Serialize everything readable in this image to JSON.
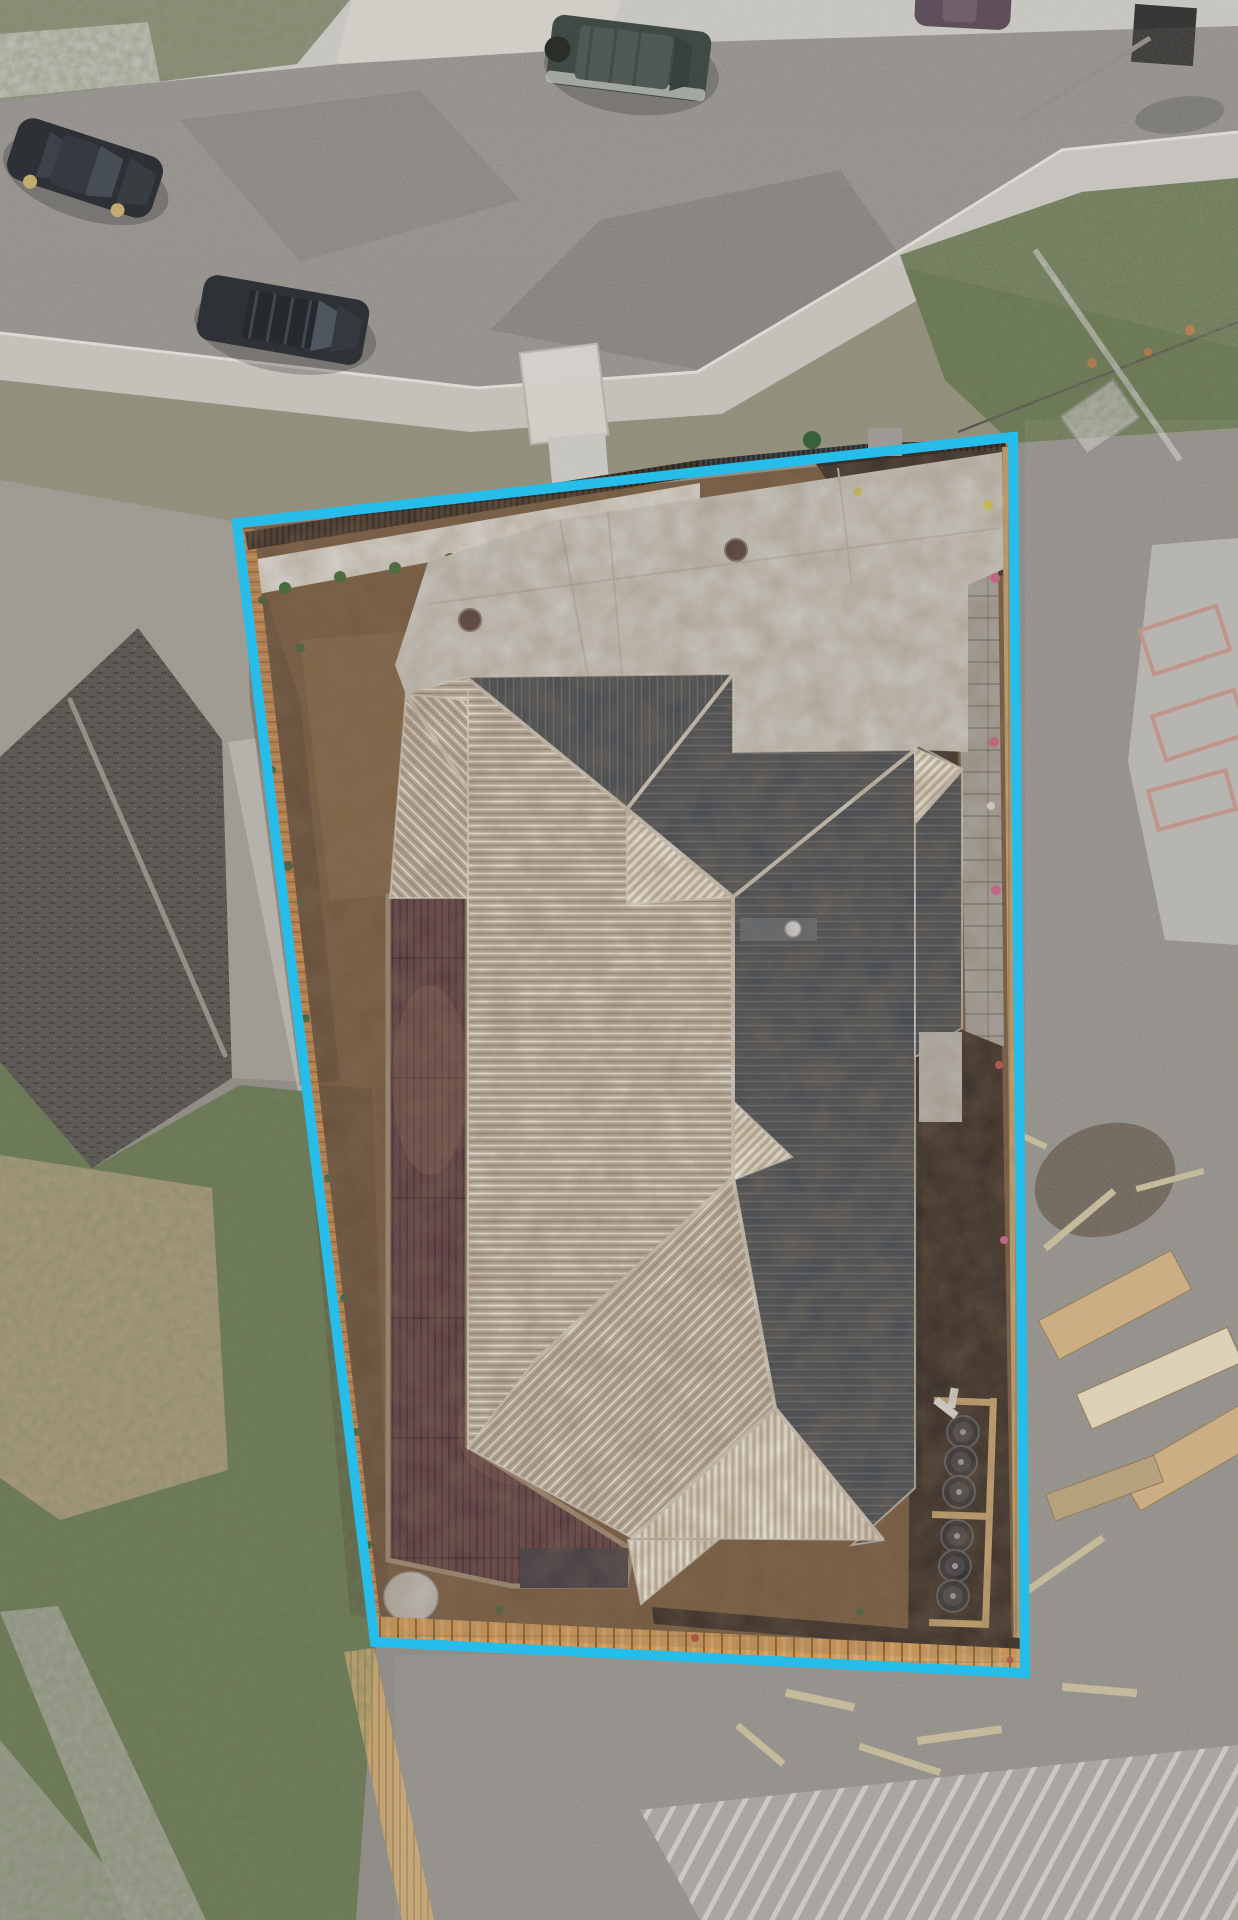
{
  "meta": {
    "type": "aerial-drone-photo",
    "subject": "residential lot with highlighted property boundary",
    "canvas": {
      "w": 1238,
      "h": 1920
    }
  },
  "colors": {
    "cyan": "#27bdea",
    "concrete": "#c8c6c0",
    "concrete_bright": "#d2cfc9",
    "path": "#c4c1bb",
    "kerb": "#dedbd5",
    "asphalt": "#8e8b86",
    "asphalt_arm": "#8a8781",
    "grass_verge": "#8f8d79",
    "grass_green": "#66724f",
    "grass_dark": "#3d5c35",
    "debris": "#98948b",
    "side_strip": "#b0ada6",
    "dirt": "#6f5339",
    "dirt_light": "#8a6a48",
    "soil_dark": "#4b3a2a",
    "pebble": "#d7d5cf",
    "fence_dark": "#33261d",
    "fence_orange": "#c28144",
    "gate_dark": "#23262a",
    "pillar": "#9b9893",
    "paling": "#c2a06b",
    "plank_orange": "#cd9550",
    "mulch": "#302620",
    "blockwall": "#a3a09a",
    "roof_dark": "#3e444b",
    "roof_dark_rib": "#59616b",
    "roof_light": "#b5aa9c",
    "roof_pale": "#d3cab7",
    "ridge": "#cdc7bc",
    "hatch_gray": "#5a6169",
    "deck": "#59383f",
    "deck_frame": "#97846f",
    "deck_patch": "#8a5f52",
    "steps_dark": "#3a343e",
    "porch": "#b5b3ae",
    "stone": "#b9b7b2",
    "shingle": "#56534d",
    "shingle_ridge": "#908d85",
    "slab": "#b2b0aa",
    "gravel": "#8d8a84",
    "tank": "#27272b",
    "tank_mid": "#3c3c42",
    "tank_dot": "#9a9aa0",
    "pipe_white": "#dcdcda",
    "car_hatch": "#23272c",
    "car_suv": "#24282e",
    "car_offroad": "#37423c",
    "car_sedan": "#584754",
    "wheel_gold": "#c2a96c",
    "glass": "#3f464e",
    "frame_pink": "#bd8b80",
    "lumber": "#c9a878",
    "lumber_light": "#ddd0b2",
    "stick": "#c2b694",
    "cone_orange": "#c96f3a",
    "plant_green": "#2f5a2f",
    "shrub_green": "#38642f",
    "flower_yellow": "#d9cf4a",
    "flower_pink": "#cf5f8a",
    "flower_white": "#ddd8d2",
    "flower_red": "#c04545",
    "red_bit": "#b5472f",
    "dark_object": "#2f2e2c"
  },
  "boundary": {
    "points": "237,523 1013,437 1025,1673 375,1642",
    "width": 10
  },
  "ground": {
    "top_concrete": "0,0 1238,0 1238,28 700,44 340,66 0,100",
    "grass_top_left": "0,0 350,0 297,64 0,102",
    "sidewalk_left": "0,34 148,22 162,92 0,108",
    "driveway_crossing": "352,0 622,0 588,92 424,98 336,62",
    "road": "0,98 340,64 700,42 1238,26 1238,132 1062,150 882,262 697,372 477,388 0,333",
    "road_arm": "882,262 1062,150 1238,132 1238,335 1085,348",
    "road_shadow1": "490,330 700,370 900,255 840,170 600,220",
    "road_shadow2": "180,120 420,90 520,200 300,262",
    "footpath": "0,333 477,388 697,372 882,262 1062,150 1238,132 1238,178 1082,192 918,300 722,414 470,432 0,380",
    "kerb_line": "0,333 477,388 697,372 882,262 1062,150 1238,132",
    "verge": "0,380 470,432 722,414 918,300 1082,192 1238,178 1238,430 1012,443 560,488 238,522 0,480",
    "verge_green": "900,255 1082,192 1238,178 1238,428 1012,443 945,380",
    "temp_fence": "958,432 1238,322",
    "debris_left": "0,480 238,522 310,1082 232,1078 222,740 138,628 0,757",
    "side_strip": "228,742 256,738 322,1086 298,1092",
    "grass_bl": "0,1062 92,1168 240,1085 312,1092 376,1640 356,1920 0,1920",
    "dirt_patch_bl": "0,1155 212,1188 228,1470 60,1520 0,1478",
    "pale_band_bl": "0,1612 58,1606 206,1920 126,1920",
    "pale_corner_bl": "0,1740 150,1920 0,1920",
    "slab_bottom": "398,1666 1030,1692 1238,1700 1238,1920 432,1920",
    "fence_bottom": "344,1652 374,1648 434,1920 402,1920",
    "frames_bottom": "640,1810 1238,1745 1238,1920 700,1920",
    "slab_right": "1128,762 1152,545 1238,538 1238,945 1165,940",
    "entry_steps": {
      "x": -39,
      "y": -46,
      "w": 78,
      "h": 92,
      "transform": "translate(564,394) rotate(-7)"
    },
    "entry_path": "548,438 605,432 612,520 556,528",
    "poles": [
      "1035,250 1180,460",
      "1018,122 1150,38"
    ],
    "dark_object": {
      "x": -31,
      "y": -29,
      "w": 62,
      "h": 58,
      "transform": "translate(1164,35) rotate(4)"
    },
    "pallet": {
      "x": -32,
      "y": -23,
      "w": 64,
      "h": 46,
      "transform": "translate(1100,417) rotate(-35)"
    },
    "mulch_heap": {
      "cx": 1105,
      "cy": 1180,
      "rx": 72,
      "ry": 55,
      "transform": "rotate(-20 1105 1180)"
    }
  },
  "lot": {
    "dirt": "243,528 1008,446 1020,1662 380,1634",
    "dirt_light_patch": "300,640 560,620 580,880 330,900",
    "dirt_dark_left": "245,532 300,700 340,1080 300,1085 250,700",
    "dirt_dark_bl": "305,1085 372,1088 390,1620 350,1615",
    "pebble_bed": "252,560 700,483 700,512 258,594",
    "fence_top": "245,532 700,460 700,476 248,550",
    "gate": "700,460 875,443 875,453 700,470",
    "fence_top_right": "875,443 1005,440 1005,452 875,452",
    "pillar": {
      "x": 868,
      "y": 428,
      "w": 34,
      "h": 28
    },
    "fence_left": "242,530 254,529 382,1633 369,1635",
    "mulch_top_right": "812,458 1006,444 1008,575 905,585 855,522",
    "blockwall": "957,560 998,553 1004,1046 966,1049",
    "blockwall_curve": "868,480 960,560 940,575 850,497",
    "mulch_right": "915,748 958,745 962,1030 1002,1046 1012,1655 908,1650",
    "paling_right": "1002,447 1016,446 1030,1662 1014,1660",
    "porch": {
      "x": 919,
      "y": 1032,
      "w": 43,
      "h": 90
    },
    "mulch_bottom": "652,1607 1020,1638 1022,1655 654,1624",
    "planks_bottom": "372,1616 1024,1649 1027,1677 376,1644",
    "stone": {
      "cx": 411,
      "cy": 1597,
      "rx": 27,
      "ry": 25
    },
    "plant": {
      "cx": 812,
      "cy": 440,
      "r": 9
    },
    "tank_frames": [
      {
        "x": -29,
        "y": -4,
        "w": 58,
        "h": 7,
        "transform": "translate(963,1402) rotate(2)"
      },
      {
        "x": -29,
        "y": -4,
        "w": 58,
        "h": 7,
        "transform": "translate(961,1516) rotate(2)"
      },
      {
        "x": -30,
        "y": -4,
        "w": 60,
        "h": 7,
        "transform": "translate(959,1624) rotate(2)"
      },
      {
        "x": -4,
        "y": -114,
        "w": 7,
        "h": 228,
        "transform": "translate(990,1512) rotate(2)"
      }
    ],
    "pipe1": {
      "x": -13,
      "y": -4,
      "w": 26,
      "h": 8,
      "transform": "translate(946,1408) rotate(38)"
    },
    "pipe2": {
      "x": -4,
      "y": -10,
      "w": 8,
      "h": 20,
      "transform": "translate(953,1398) rotate(10)"
    }
  },
  "driveway": {
    "slab": "395,665 428,562 556,520 1002,452 1006,568 968,585 968,752 919,750 733,752 733,674 466,677 406,695",
    "joints": [
      "560,520 588,676",
      "838,468 852,585",
      "428,604 1000,528",
      "608,512 622,674"
    ],
    "drains": [
      {
        "cx": 470,
        "cy": 620
      },
      {
        "cx": 736,
        "cy": 550
      }
    ],
    "eave_shadow_top": "406,698 733,680",
    "eave_shadow_right": "919,755 919,1488"
  },
  "deck": {
    "body": "388,896 468,894 468,1446 632,1550 626,1586 512,1586 388,1560",
    "steps": {
      "x": 520,
      "y": 1548,
      "w": 108,
      "h": 40
    },
    "patch1": {
      "cx": 430,
      "cy": 1080,
      "rx": 38,
      "ry": 95
    },
    "patch2": {
      "cx": 520,
      "cy": 1430,
      "rx": 62,
      "ry": 55
    }
  },
  "roof": {
    "garage": "406,694 468,700 468,898 390,898",
    "light_main": "466,677 627,809 733,897 733,1178 534,1362 468,1448 468,700 406,694",
    "dark_front": "466,677 733,674 627,809",
    "dark_main": "733,674 733,752 915,750 915,1488 852,1545 883,1540 775,1408 733,1178 733,897 627,809",
    "light_sw": "733,1178 775,1408 632,1538 468,1448 534,1362",
    "pale_south": "632,1538 883,1540 775,1408",
    "fan_ne": "627,809 733,897 627,904",
    "fan_mid": "733,1101 792,1157 733,1180",
    "fan_s": "628,1540 718,1540 641,1604",
    "wing": "915,748 919,746 962,769 962,1028 917,1056 915,1056",
    "wing_hip": "915,748 962,769 915,822",
    "hatch": {
      "x": 740,
      "y": 918,
      "w": 77,
      "h": 23
    },
    "vent": {
      "cx": 793,
      "cy": 929,
      "r": 8
    },
    "panel_line": "468,690 468,1448",
    "ridges": [
      "466,677 627,809",
      "733,674 627,809",
      "627,809 733,897",
      "733,897 915,750",
      "733,897 733,1178",
      "733,1178 534,1362",
      "733,1178 775,1408",
      "775,1408 632,1538",
      "775,1408 883,1540",
      "406,694 468,790",
      "915,822 962,769"
    ]
  },
  "tanks": [
    {
      "cx": 963,
      "cy": 1432
    },
    {
      "cx": 961,
      "cy": 1462
    },
    {
      "cx": 959,
      "cy": 1492
    },
    {
      "cx": 957,
      "cy": 1536
    },
    {
      "cx": 955,
      "cy": 1566
    },
    {
      "cx": 953,
      "cy": 1596
    }
  ],
  "shrubs": [
    {
      "cx": 285,
      "cy": 588
    },
    {
      "cx": 340,
      "cy": 577
    },
    {
      "cx": 395,
      "cy": 568
    },
    {
      "cx": 450,
      "cy": 559
    },
    {
      "cx": 505,
      "cy": 550
    },
    {
      "cx": 560,
      "cy": 541
    },
    {
      "cx": 620,
      "cy": 532
    },
    {
      "cx": 678,
      "cy": 523
    }
  ],
  "weeds": [
    {
      "cx": 262,
      "cy": 600,
      "r": 4
    },
    {
      "cx": 300,
      "cy": 648,
      "r": 5
    },
    {
      "cx": 272,
      "cy": 770,
      "r": 4
    },
    {
      "cx": 288,
      "cy": 866,
      "r": 5
    },
    {
      "cx": 306,
      "cy": 1018,
      "r": 4
    },
    {
      "cx": 328,
      "cy": 1178,
      "r": 4
    },
    {
      "cx": 344,
      "cy": 1298,
      "r": 4
    },
    {
      "cx": 356,
      "cy": 1432,
      "r": 4
    },
    {
      "cx": 368,
      "cy": 1545,
      "r": 4
    },
    {
      "cx": 500,
      "cy": 1610,
      "r": 4
    },
    {
      "cx": 860,
      "cy": 1612,
      "r": 4
    },
    {
      "cx": 300,
      "cy": 903,
      "r": 3
    }
  ],
  "flowers": [
    {
      "cx": 988,
      "cy": 505,
      "c": "#d9cf4a"
    },
    {
      "cx": 858,
      "cy": 492,
      "c": "#cfc14a"
    },
    {
      "cx": 995,
      "cy": 578,
      "c": "#cf5f8a"
    },
    {
      "cx": 994,
      "cy": 742,
      "c": "#cf5f8a"
    },
    {
      "cx": 991,
      "cy": 806,
      "c": "#ddd8d2"
    },
    {
      "cx": 996,
      "cy": 890,
      "c": "#cf5f8a"
    },
    {
      "cx": 999,
      "cy": 1065,
      "c": "#c04545"
    },
    {
      "cx": 1004,
      "cy": 1240,
      "c": "#cf5f8a"
    }
  ],
  "red_bits": [
    {
      "cx": 695,
      "cy": 1638
    },
    {
      "cx": 1010,
      "cy": 1660
    }
  ],
  "cones": [
    {
      "cx": 1092,
      "cy": 363
    },
    {
      "cx": 1190,
      "cy": 330
    },
    {
      "cx": 1148,
      "cy": 352
    }
  ],
  "cars": [
    {
      "transform": "translate(85,168) rotate(18)"
    },
    {
      "transform": "translate(283,320) rotate(10)"
    },
    {
      "transform": "translate(629,58) rotate(7)"
    },
    {
      "transform": "translate(963,6) rotate(3)"
    }
  ],
  "neighbors": {
    "shingle_roof": "0,757 138,628 222,740 232,1078 92,1168 0,1062",
    "shingle_ridge": "70,700 225,1055",
    "pink_frames": [
      {
        "x": -40,
        "y": -23,
        "w": 80,
        "h": 46,
        "transform": "translate(1185,640) rotate(-18)"
      },
      {
        "x": -43,
        "y": -23,
        "w": 86,
        "h": 46,
        "transform": "translate(1200,725) rotate(-18)"
      },
      {
        "x": -40,
        "y": -20,
        "w": 80,
        "h": 40,
        "transform": "translate(1192,800) rotate(-15)"
      }
    ],
    "lumber_stacks": [
      {
        "x": -75,
        "y": -22,
        "w": 150,
        "h": 44,
        "transform": "translate(1115,1305) rotate(-28)",
        "c": "#c9a878"
      },
      {
        "x": -83,
        "y": -19,
        "w": 165,
        "h": 38,
        "transform": "translate(1160,1378) rotate(-24)",
        "c": "#ddd0b2"
      },
      {
        "x": -75,
        "y": -21,
        "w": 150,
        "h": 42,
        "transform": "translate(1195,1455) rotate(-30)",
        "c": "#c9a878"
      },
      {
        "x": -58,
        "y": -14,
        "w": 115,
        "h": 28,
        "transform": "translate(1105,1488) rotate(-20)",
        "c": "#b19a72"
      }
    ],
    "sticks": [
      {
        "x": -45,
        "y": -4,
        "w": 90,
        "h": 7,
        "transform": "translate(1080,1220) rotate(-40)"
      },
      {
        "x": -40,
        "y": -3,
        "w": 80,
        "h": 6,
        "transform": "translate(1010,1130) rotate(25)"
      },
      {
        "x": -35,
        "y": -3,
        "w": 70,
        "h": 6,
        "transform": "translate(1170,1180) rotate(-15)"
      },
      {
        "x": -48,
        "y": -4,
        "w": 95,
        "h": 7,
        "transform": "translate(1065,1565) rotate(-35)"
      },
      {
        "x": -43,
        "y": -4,
        "w": 85,
        "h": 7,
        "transform": "translate(900,1760) rotate(18)"
      },
      {
        "x": -35,
        "y": -4,
        "w": 70,
        "h": 8,
        "transform": "translate(820,1700) rotate(12)"
      },
      {
        "x": -43,
        "y": -4,
        "w": 85,
        "h": 8,
        "transform": "translate(960,1735) rotate(-8)"
      },
      {
        "x": -30,
        "y": -4,
        "w": 60,
        "h": 7,
        "transform": "translate(760,1745) rotate(40)"
      },
      {
        "x": -38,
        "y": -4,
        "w": 75,
        "h": 8,
        "transform": "translate(1100,1690) rotate(5)"
      }
    ]
  }
}
